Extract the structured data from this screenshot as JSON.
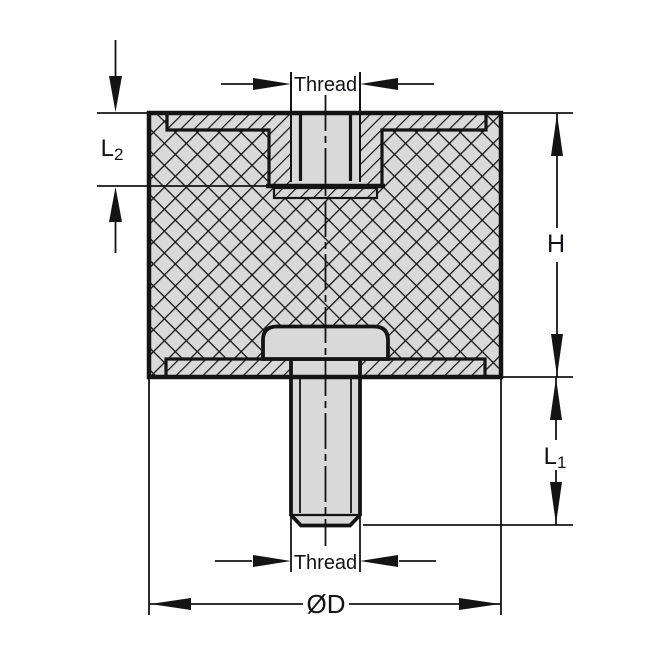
{
  "title": "Rubber anti-vibration mount cross-section drawing",
  "colors": {
    "line": "#141414",
    "fill": "#d9d9d9",
    "background": "#ffffff",
    "text": "#121218"
  },
  "dimensions": {
    "thread_top": {
      "label": "Thread"
    },
    "l2": {
      "label": "L",
      "sub": "2"
    },
    "h": {
      "label": "H"
    },
    "l1": {
      "label": "L",
      "sub": "1"
    },
    "thread_bottom": {
      "label": "Thread"
    },
    "diameter": {
      "label": "ØD"
    }
  }
}
